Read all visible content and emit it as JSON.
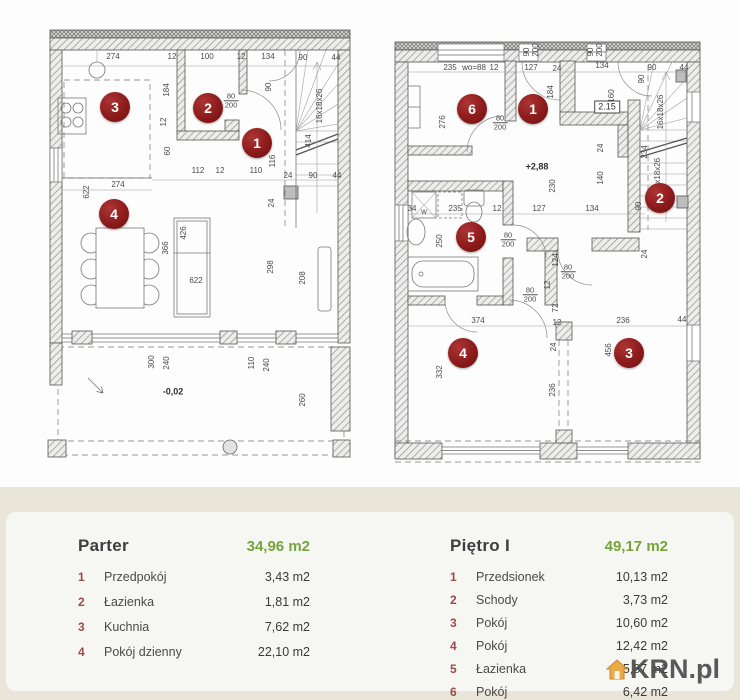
{
  "colors": {
    "badge_red": "#8c1b1b",
    "green": "#76a43c",
    "beige_band": "#e9e5d9",
    "card": "#f6f6f3",
    "dim_text": "#4a4a4a"
  },
  "watermark": {
    "text": "KRN.pl",
    "icon": "house-icon",
    "icon_color": "#e8a53a"
  },
  "plans": {
    "parter": {
      "badges": [
        {
          "n": "3",
          "x": 115,
          "y": 107
        },
        {
          "n": "2",
          "x": 208,
          "y": 108
        },
        {
          "n": "1",
          "x": 257,
          "y": 143
        },
        {
          "n": "4",
          "x": 114,
          "y": 214
        }
      ],
      "labels": [
        {
          "t": "274",
          "x": 113,
          "y": 57
        },
        {
          "t": "12",
          "x": 172,
          "y": 57
        },
        {
          "t": "100",
          "x": 207,
          "y": 57
        },
        {
          "t": "12",
          "x": 241,
          "y": 57
        },
        {
          "t": "134",
          "x": 268,
          "y": 57
        },
        {
          "t": "90",
          "x": 303,
          "y": 58
        },
        {
          "t": "44",
          "x": 336,
          "y": 58
        },
        {
          "t": "184",
          "x": 167,
          "y": 90,
          "r": 1
        },
        {
          "t": "90",
          "x": 269,
          "y": 87,
          "r": 1
        },
        {
          "t": "80",
          "b": "200",
          "x": 231,
          "y": 101,
          "kind": "frac"
        },
        {
          "t": "12",
          "x": 164,
          "y": 122,
          "r": 1
        },
        {
          "t": "60",
          "x": 168,
          "y": 151,
          "r": 1
        },
        {
          "t": "116",
          "x": 273,
          "y": 161,
          "r": 1
        },
        {
          "t": "414",
          "x": 309,
          "y": 141,
          "r": 1
        },
        {
          "t": "16x18x26",
          "x": 320,
          "y": 106,
          "r": 1
        },
        {
          "t": "112",
          "x": 198,
          "y": 171
        },
        {
          "t": "12",
          "x": 220,
          "y": 171
        },
        {
          "t": "110",
          "x": 256,
          "y": 171
        },
        {
          "t": "24",
          "x": 288,
          "y": 176
        },
        {
          "t": "90",
          "x": 313,
          "y": 176
        },
        {
          "t": "44",
          "x": 337,
          "y": 176
        },
        {
          "t": "274",
          "x": 118,
          "y": 185
        },
        {
          "t": "622",
          "x": 87,
          "y": 192,
          "r": 1
        },
        {
          "t": "24",
          "x": 272,
          "y": 203,
          "r": 1
        },
        {
          "t": "366",
          "x": 166,
          "y": 248,
          "r": 1
        },
        {
          "t": "426",
          "x": 184,
          "y": 233,
          "r": 1
        },
        {
          "t": "622",
          "x": 196,
          "y": 281
        },
        {
          "t": "298",
          "x": 271,
          "y": 267,
          "r": 1
        },
        {
          "t": "208",
          "x": 303,
          "y": 278,
          "r": 1
        },
        {
          "t": "300",
          "x": 152,
          "y": 362,
          "r": 1
        },
        {
          "t": "240",
          "x": 167,
          "y": 363,
          "r": 1
        },
        {
          "t": "-0,02",
          "x": 173,
          "y": 392,
          "kind": "level"
        },
        {
          "t": "110",
          "x": 252,
          "y": 363,
          "r": 1
        },
        {
          "t": "240",
          "x": 267,
          "y": 365,
          "r": 1
        },
        {
          "t": "260",
          "x": 303,
          "y": 400,
          "r": 1
        }
      ]
    },
    "pietro": {
      "badges": [
        {
          "n": "6",
          "x": 472,
          "y": 109
        },
        {
          "n": "1",
          "x": 533,
          "y": 109
        },
        {
          "n": "2",
          "x": 660,
          "y": 198
        },
        {
          "n": "5",
          "x": 471,
          "y": 237
        },
        {
          "n": "4",
          "x": 463,
          "y": 353
        },
        {
          "n": "3",
          "x": 629,
          "y": 353
        }
      ],
      "labels": [
        {
          "t": "235",
          "x": 450,
          "y": 68
        },
        {
          "t": "wo=88",
          "x": 474,
          "y": 68
        },
        {
          "t": "12",
          "x": 494,
          "y": 68
        },
        {
          "t": "127",
          "x": 531,
          "y": 68
        },
        {
          "t": "24",
          "x": 557,
          "y": 69
        },
        {
          "t": "134",
          "x": 602,
          "y": 66
        },
        {
          "t": "90",
          "x": 652,
          "y": 68
        },
        {
          "t": "44",
          "x": 684,
          "y": 68
        },
        {
          "t": "90",
          "x": 527,
          "y": 52,
          "r": 1
        },
        {
          "t": "200",
          "x": 536,
          "y": 50,
          "r": 1
        },
        {
          "t": "90",
          "x": 591,
          "y": 52,
          "r": 1
        },
        {
          "t": "200",
          "x": 600,
          "y": 50,
          "r": 1
        },
        {
          "t": "184",
          "x": 551,
          "y": 92,
          "r": 1
        },
        {
          "t": "160",
          "x": 612,
          "y": 96,
          "r": 1
        },
        {
          "t": "2.15",
          "x": 607,
          "y": 107,
          "kind": "box"
        },
        {
          "t": "16x18x26",
          "x": 661,
          "y": 112,
          "r": 1
        },
        {
          "t": "90",
          "x": 642,
          "y": 79,
          "r": 1
        },
        {
          "t": "234",
          "x": 645,
          "y": 152,
          "r": 1
        },
        {
          "t": "6x18x26",
          "x": 658,
          "y": 173,
          "r": 1
        },
        {
          "t": "276",
          "x": 443,
          "y": 122,
          "r": 1
        },
        {
          "t": "80",
          "b": "200",
          "x": 500,
          "y": 123,
          "kind": "frac"
        },
        {
          "t": "+2,88",
          "x": 537,
          "y": 167,
          "kind": "level"
        },
        {
          "t": "24",
          "x": 601,
          "y": 148,
          "r": 1
        },
        {
          "t": "140",
          "x": 601,
          "y": 178,
          "r": 1
        },
        {
          "t": "230",
          "x": 553,
          "y": 186,
          "r": 1
        },
        {
          "t": "34",
          "x": 412,
          "y": 209
        },
        {
          "t": "235",
          "x": 455,
          "y": 209
        },
        {
          "t": "12",
          "x": 497,
          "y": 209
        },
        {
          "t": "127",
          "x": 539,
          "y": 209
        },
        {
          "t": "134",
          "x": 592,
          "y": 209
        },
        {
          "t": "90",
          "x": 639,
          "y": 206,
          "r": 1
        },
        {
          "t": "w",
          "x": 424,
          "y": 212
        },
        {
          "t": "250",
          "x": 440,
          "y": 241,
          "r": 1
        },
        {
          "t": "80",
          "b": "200",
          "x": 508,
          "y": 240,
          "kind": "frac"
        },
        {
          "t": "124",
          "x": 556,
          "y": 260,
          "r": 1
        },
        {
          "t": "80",
          "b": "200",
          "x": 568,
          "y": 272,
          "kind": "frac"
        },
        {
          "t": "12",
          "x": 548,
          "y": 285,
          "r": 1
        },
        {
          "t": "80",
          "b": "200",
          "x": 530,
          "y": 295,
          "kind": "frac"
        },
        {
          "t": "72",
          "x": 556,
          "y": 308,
          "r": 1
        },
        {
          "t": "24",
          "x": 645,
          "y": 254,
          "r": 1
        },
        {
          "t": "374",
          "x": 478,
          "y": 321
        },
        {
          "t": "12",
          "x": 557,
          "y": 323
        },
        {
          "t": "236",
          "x": 623,
          "y": 321
        },
        {
          "t": "44",
          "x": 682,
          "y": 320
        },
        {
          "t": "332",
          "x": 440,
          "y": 372,
          "r": 1
        },
        {
          "t": "24",
          "x": 554,
          "y": 347,
          "r": 1
        },
        {
          "t": "456",
          "x": 609,
          "y": 350,
          "r": 1
        },
        {
          "t": "236",
          "x": 553,
          "y": 390,
          "r": 1
        }
      ]
    }
  },
  "legend": {
    "parter": {
      "title": "Parter",
      "total": "34,96 m2",
      "rows": [
        {
          "n": "1",
          "name": "Przedpokój",
          "area": "3,43 m2"
        },
        {
          "n": "2",
          "name": "Łazienka",
          "area": "1,81 m2"
        },
        {
          "n": "3",
          "name": "Kuchnia",
          "area": "7,62 m2"
        },
        {
          "n": "4",
          "name": "Pokój dzienny",
          "area": "22,10 m2"
        }
      ]
    },
    "pietro": {
      "title": "Piętro I",
      "total": "49,17 m2",
      "rows": [
        {
          "n": "1",
          "name": "Przedsionek",
          "area": "10,13 m2"
        },
        {
          "n": "2",
          "name": "Schody",
          "area": "3,73 m2"
        },
        {
          "n": "3",
          "name": "Pokój",
          "area": "10,60 m2"
        },
        {
          "n": "4",
          "name": "Pokój",
          "area": "12,42 m2"
        },
        {
          "n": "5",
          "name": "Łazienka",
          "area": "5,87 m2"
        },
        {
          "n": "6",
          "name": "Pokój",
          "area": "6,42 m2"
        }
      ]
    }
  }
}
